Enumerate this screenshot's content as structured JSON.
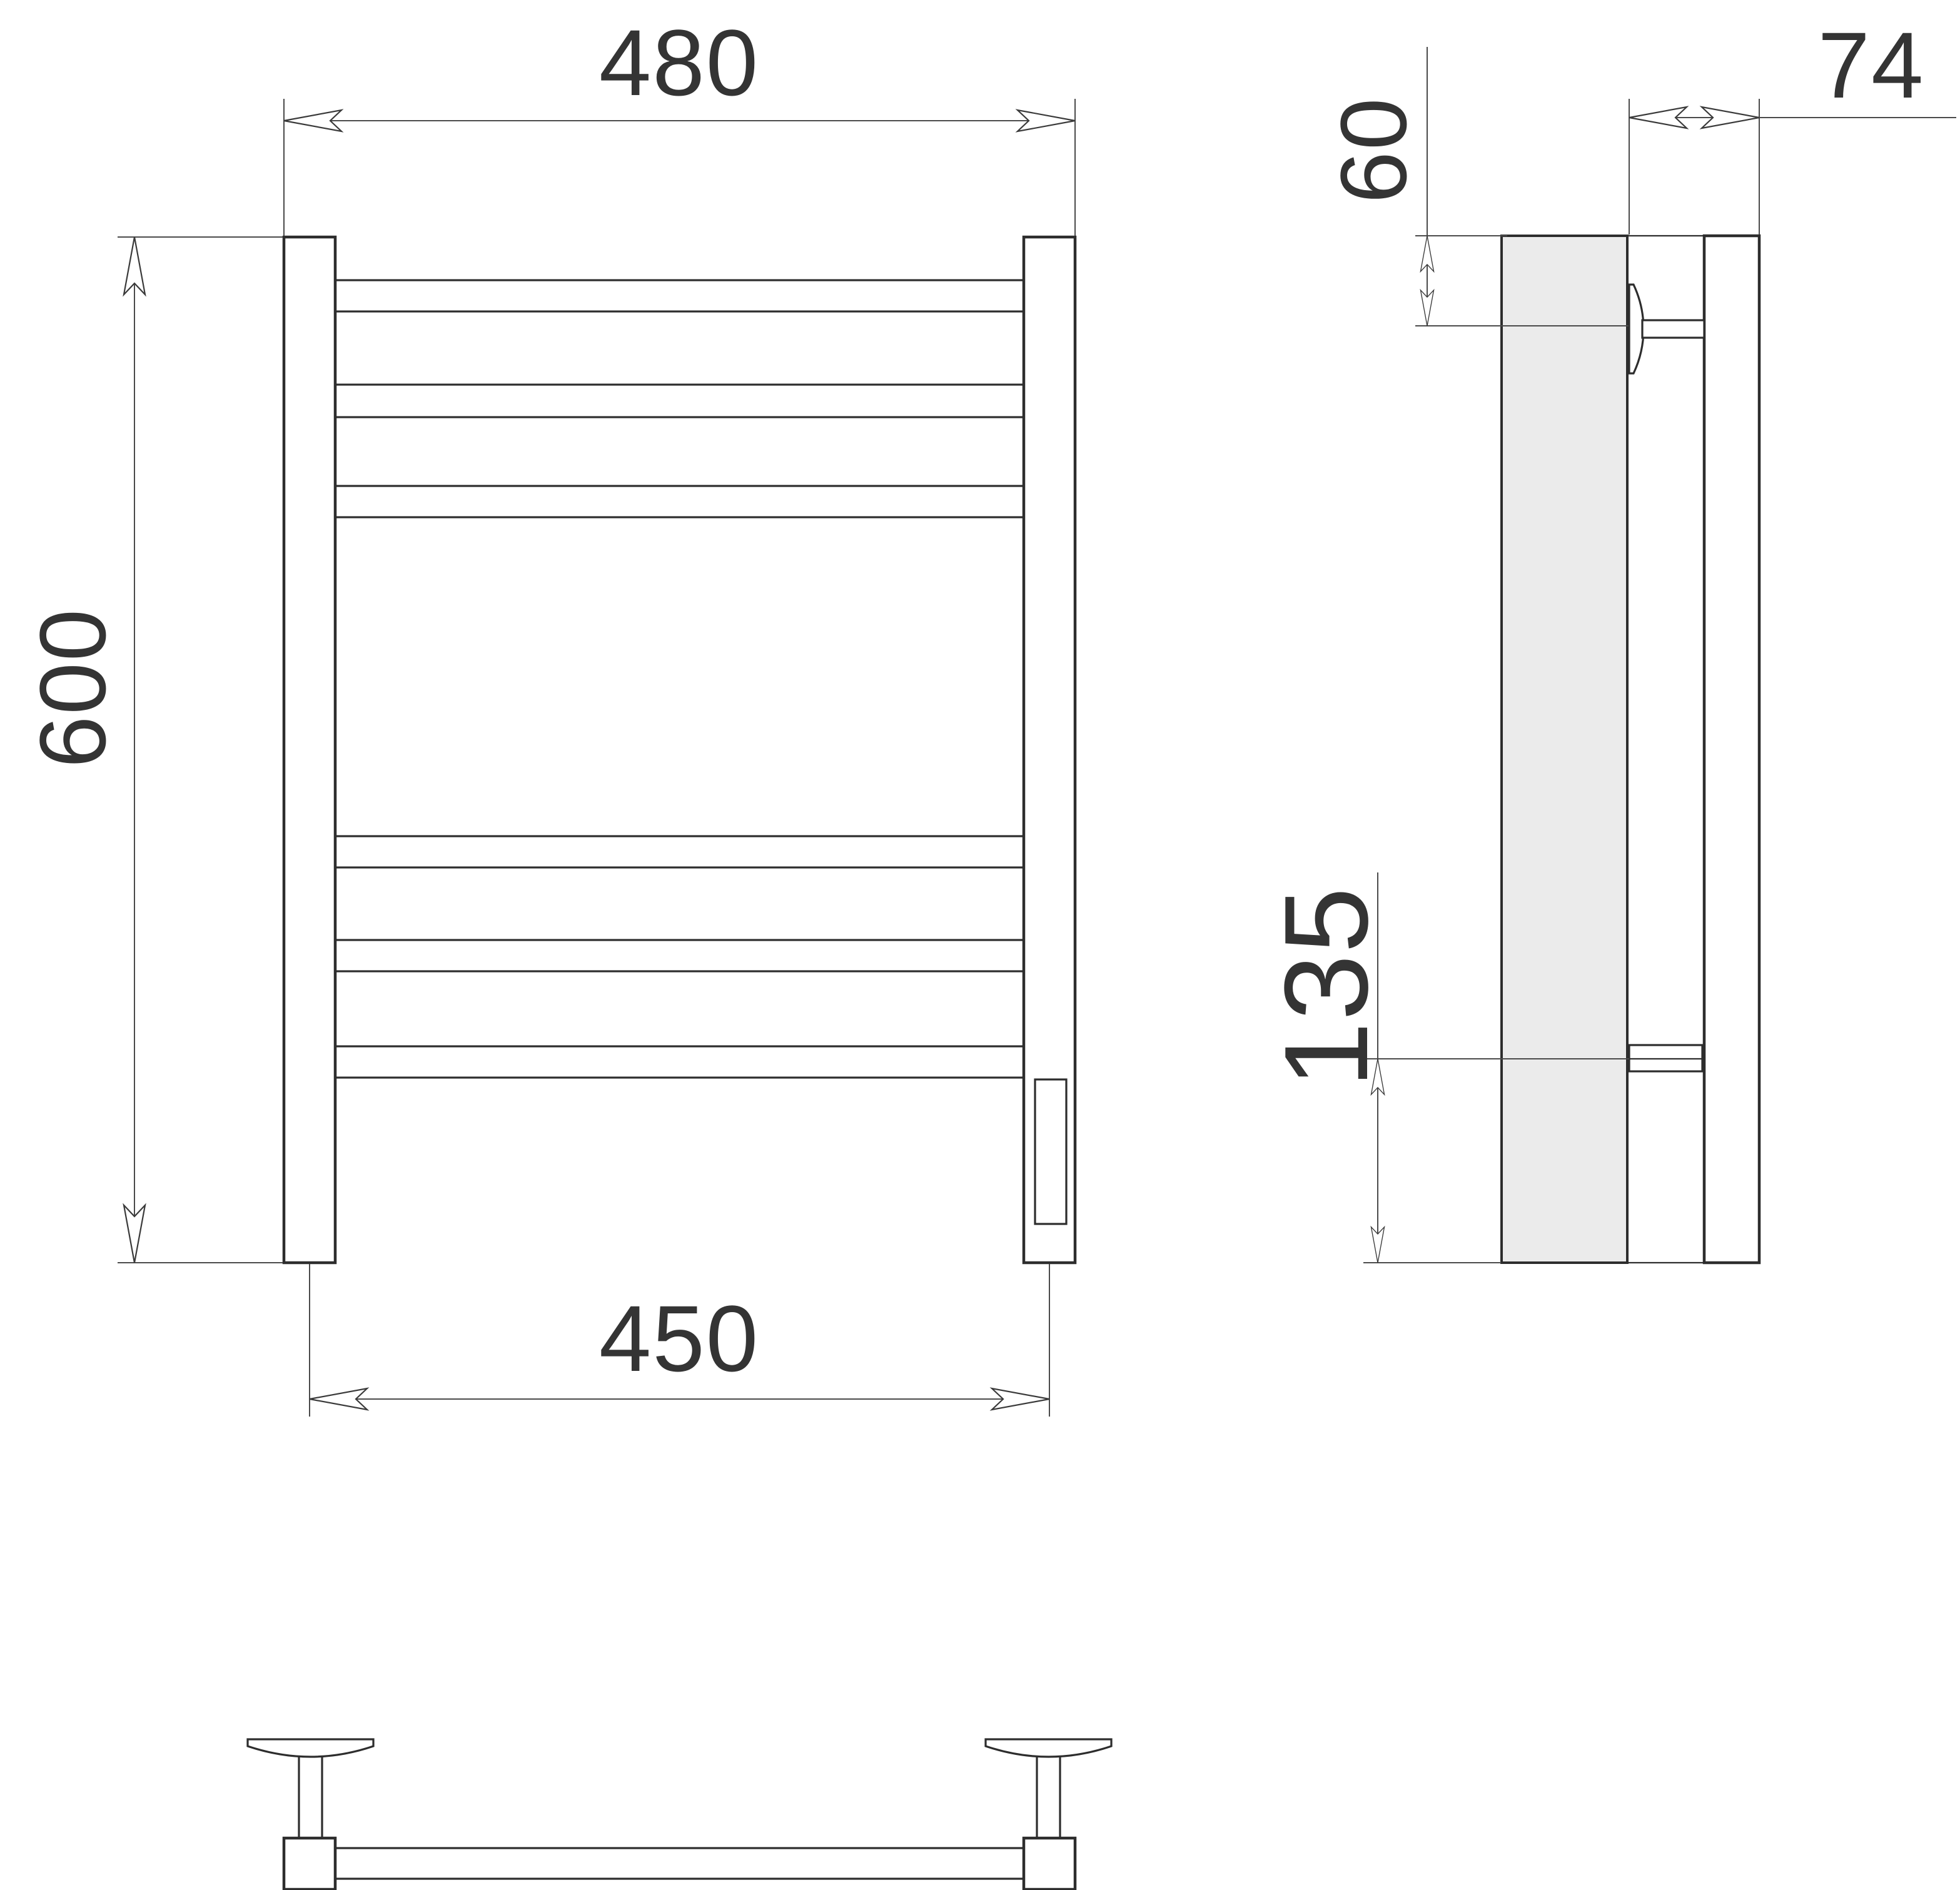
{
  "drawing": {
    "type": "technical-dimension-drawing",
    "subject": "wall-mounted towel rail",
    "colors": {
      "background": "#ffffff",
      "outline": "#2d2d2d",
      "dimension_lines": "#4a4a4a",
      "text": "#343434",
      "panel_fill": "#ebebeb"
    }
  },
  "views": {
    "front": {
      "rail_count": 6,
      "dimensions": {
        "overall_width": "480",
        "overall_height": "600",
        "mounting_centers": "450"
      }
    },
    "side": {
      "bracket_count": 2,
      "dimensions": {
        "depth": "74",
        "top_bracket_offset": "60",
        "bottom_bracket_offset": "135"
      }
    },
    "bottom": {
      "bracket_count": 2
    }
  }
}
